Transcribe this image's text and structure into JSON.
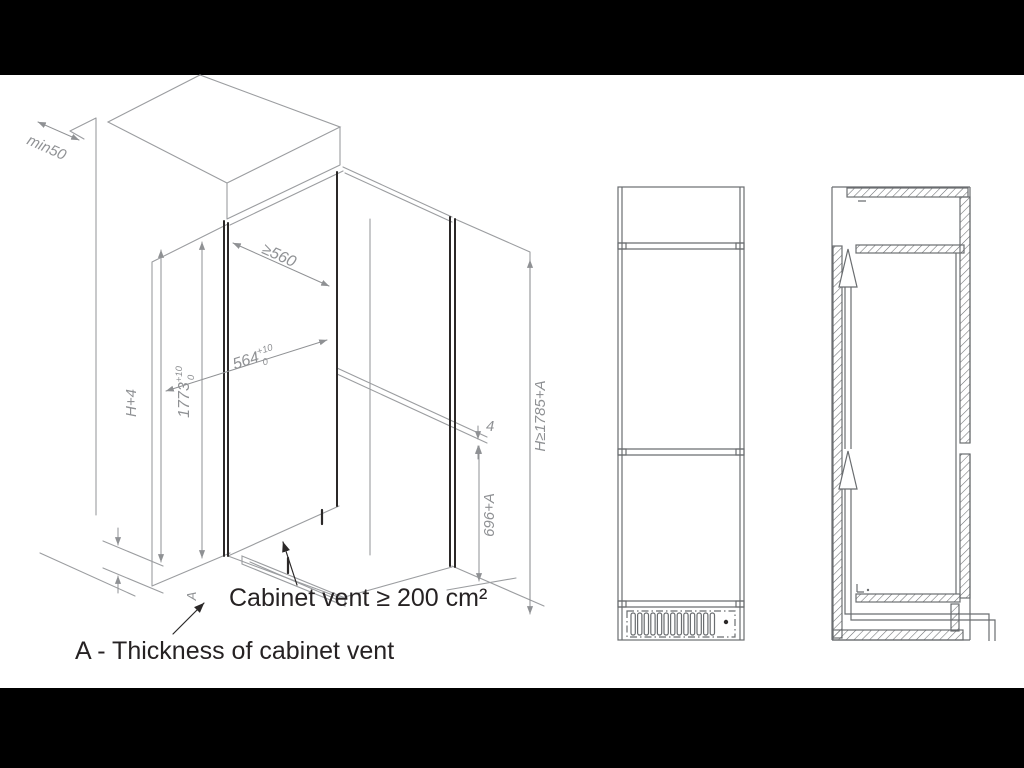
{
  "page": {
    "background": "#000000",
    "paper_color": "#ffffff"
  },
  "drawing": {
    "colors": {
      "line_light": "#9b9da0",
      "line_dark": "#2b2828",
      "dim_text_color": "#8f9194",
      "label_text_color": "#262223"
    },
    "dims": {
      "rear_clearance": "min50",
      "depth": "≥560",
      "width_value": "564",
      "width_tol_plus": "+10",
      "width_tol_minus": "0",
      "height_value": "1773",
      "height_tol_plus": "+10",
      "height_tol_minus": "0",
      "front_height": "H+4",
      "overall_height": "H≥1785+A",
      "vent_height": "696+A",
      "top_gap": "4",
      "vent_thickness": "A"
    },
    "notes": {
      "vent_note": "Cabinet vent ≥ 200 cm²",
      "legend": "A - Thickness of cabinet vent"
    }
  }
}
